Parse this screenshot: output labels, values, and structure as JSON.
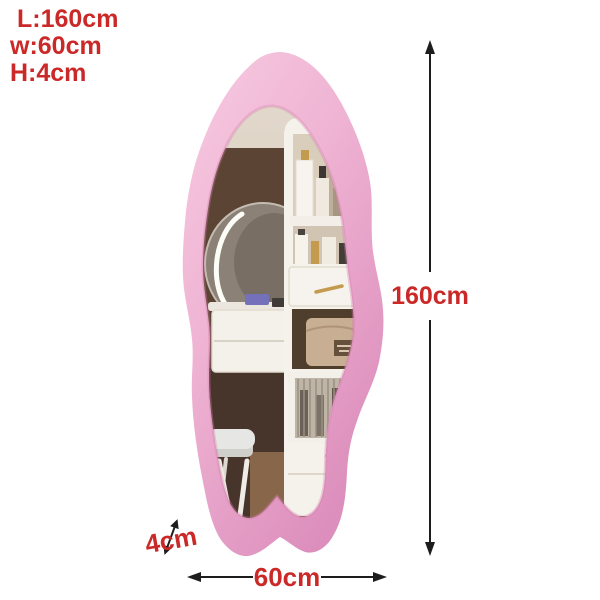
{
  "annotations": {
    "spec_lines": [
      "L:160cm",
      "w:60cm",
      "H:4cm"
    ],
    "height_label": "160cm",
    "width_label": "60cm",
    "thickness_label": "4cm"
  },
  "colors": {
    "annotation_red": "#cb2928",
    "arrow_black": "#1d1d1d",
    "background": "#ffffff",
    "frame_pink_light": "#f7cbe1",
    "frame_pink": "#efb3d3",
    "frame_pink_deep": "#dc8ebc",
    "frame_inner_shadow": "#d67fb0",
    "glass_light": "#e2d8cb",
    "glass_dark": "#cfc1b0",
    "wall_brown": "#5b4433",
    "floor_brown": "#47342a",
    "floor_light": "#8f6c4d",
    "furniture_white": "#f5f2ec",
    "gold": "#c49a4e",
    "bag_beige": "#c8ae92",
    "bag_label": "#65503c",
    "cushion_gray": "#e6e6e4",
    "led_face": "#877d73",
    "led_ring": "#fdfdf8"
  },
  "icons": {
    "height_arrow": "double-arrow-vertical",
    "width_arrow": "double-arrow-horizontal",
    "thickness_arrow": "double-arrow-diagonal"
  },
  "scene": {
    "subject": "pink wavy-edge full-length floor mirror",
    "reflection": "white vanity dresser with round LED mirror, cosmetic shelves, drawers with gold handles, beige handbag, fluted-glass cabinet and white stool"
  }
}
